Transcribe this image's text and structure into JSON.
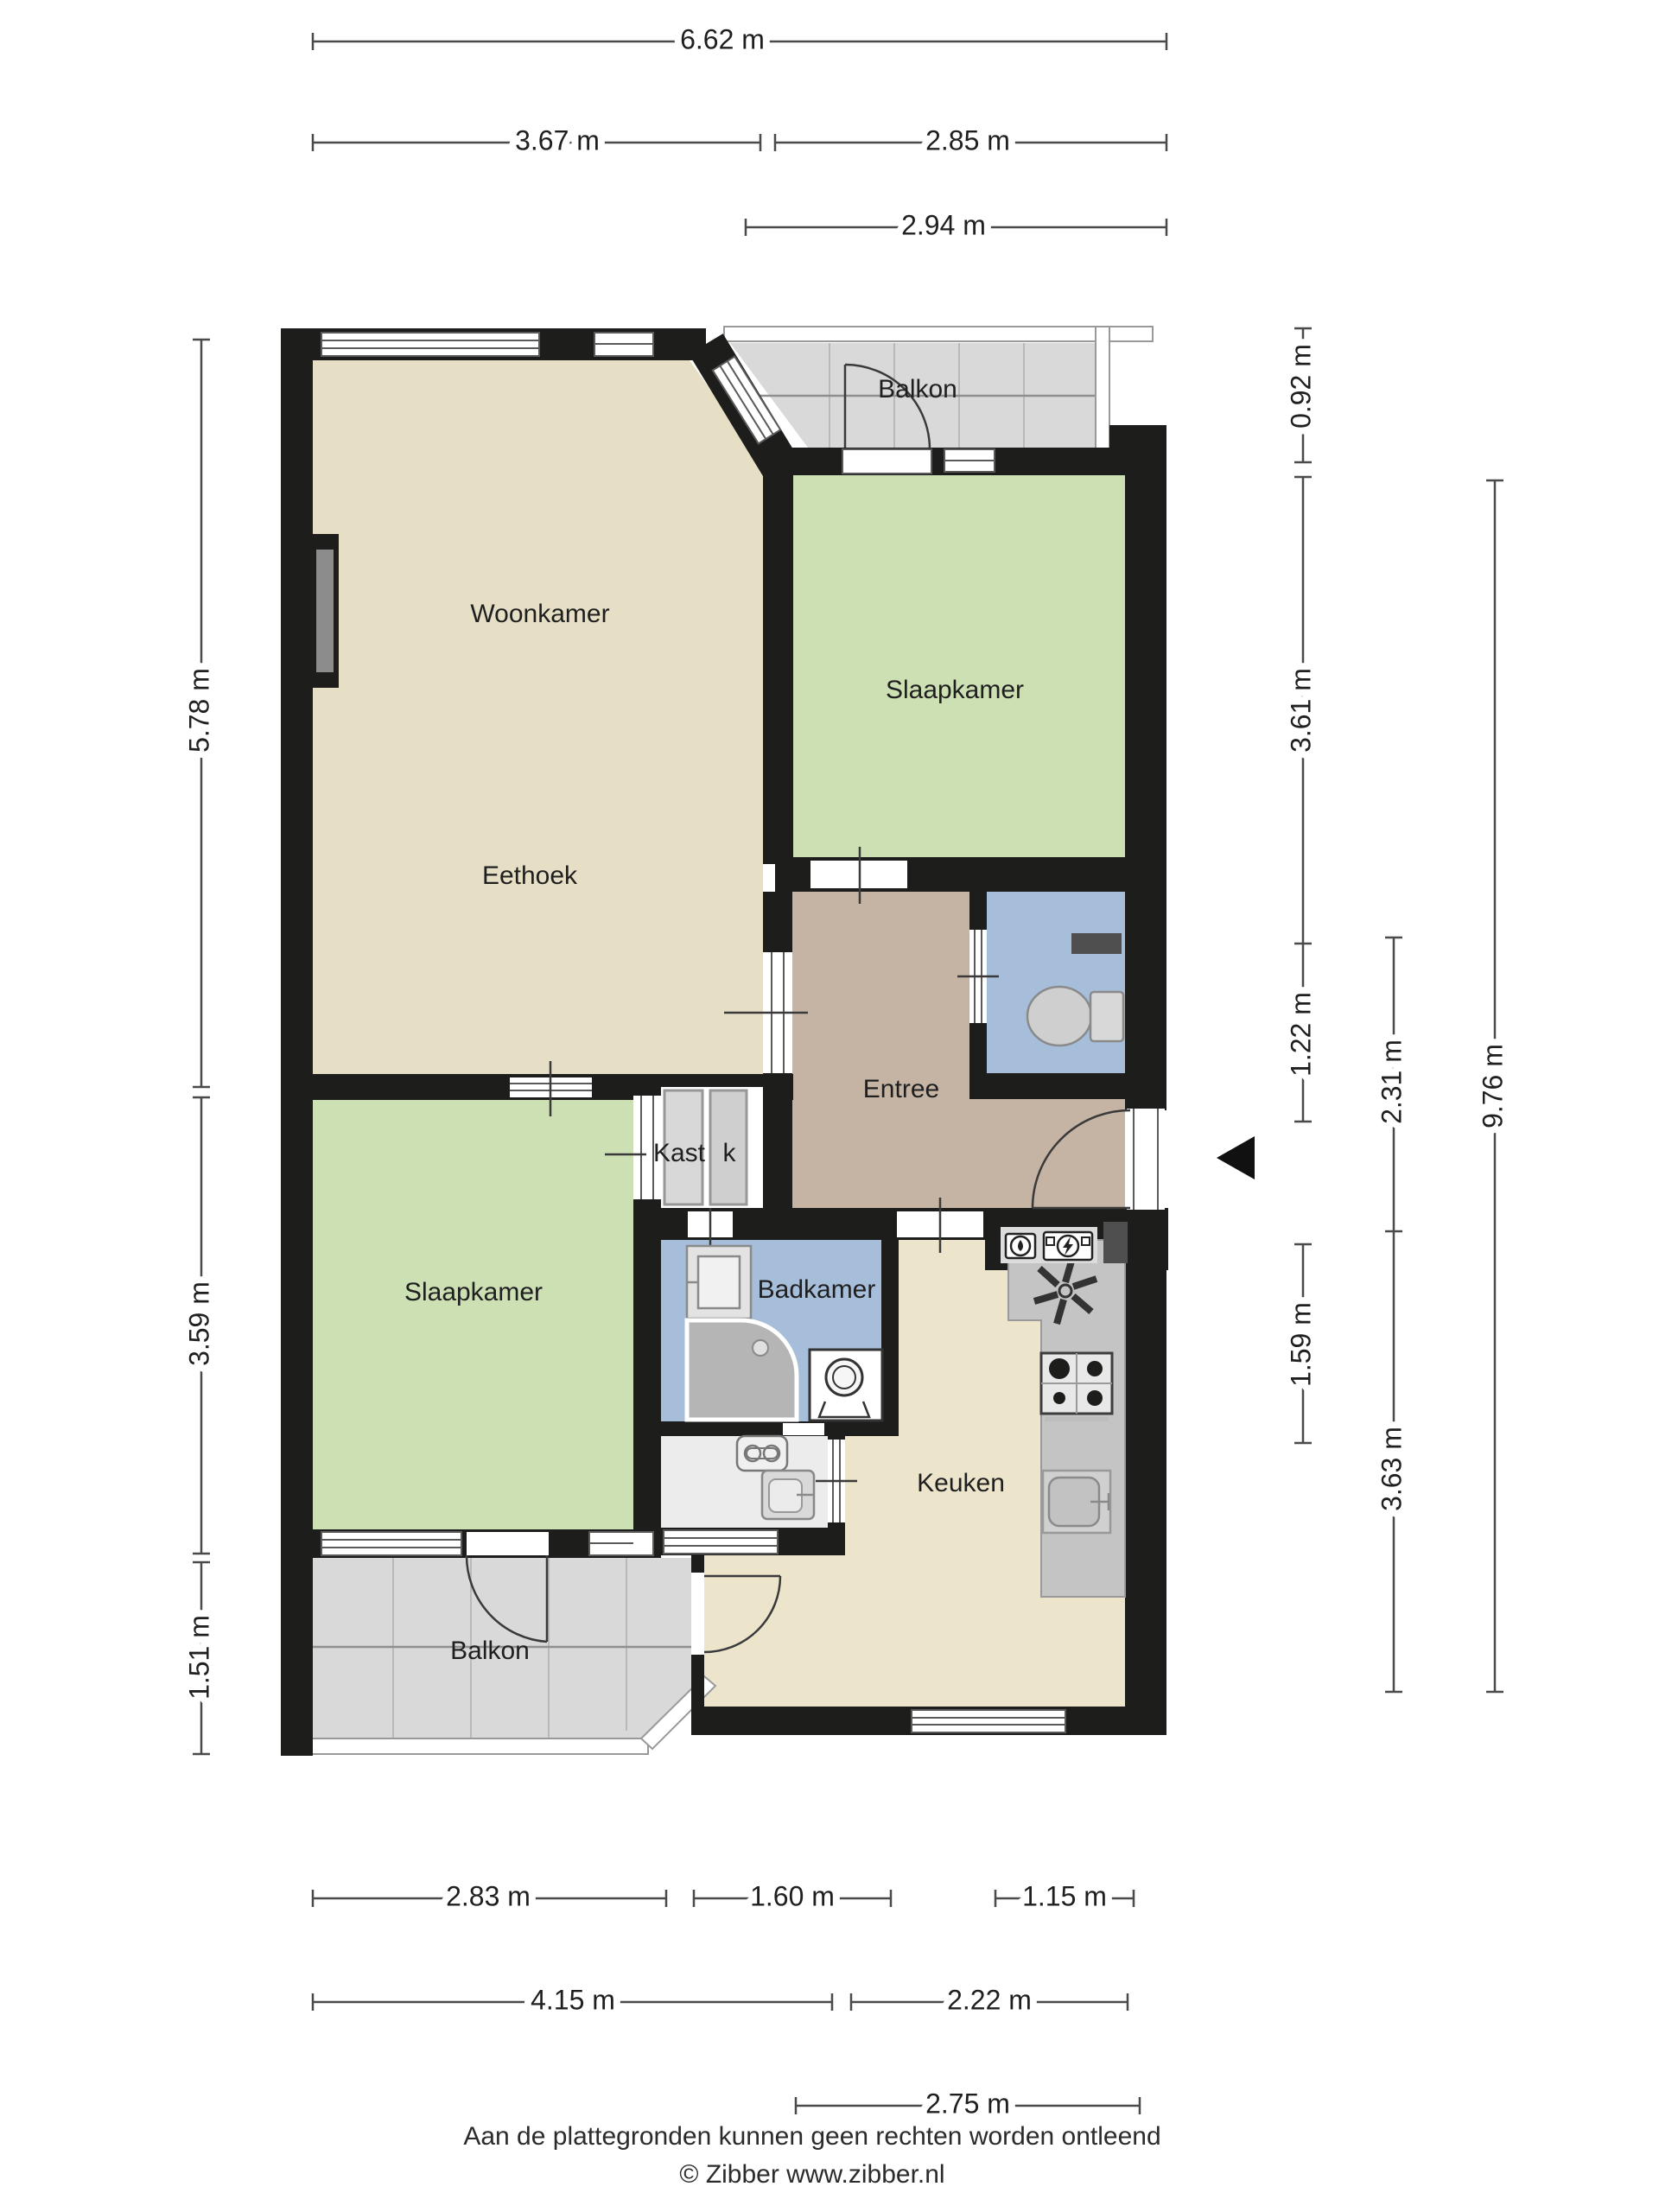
{
  "rooms": {
    "balkon_top": {
      "label": "Balkon"
    },
    "woonkamer": {
      "label": "Woonkamer"
    },
    "slaapkamer_top": {
      "label": "Slaapkamer"
    },
    "eethoek": {
      "label": "Eethoek"
    },
    "entree": {
      "label": "Entree"
    },
    "kast": {
      "label": "Kast"
    },
    "kast_small": {
      "label": "k"
    },
    "slaapkamer_onder": {
      "label": "Slaapkamer"
    },
    "badkamer": {
      "label": "Badkamer"
    },
    "keuken": {
      "label": "Keuken"
    },
    "balkon_onder": {
      "label": "Balkon"
    }
  },
  "dimensions": {
    "top": [
      {
        "label": "6.62 m"
      },
      {
        "label": "3.67 m"
      },
      {
        "label": "2.85 m"
      },
      {
        "label": "2.94 m"
      }
    ],
    "left": [
      {
        "label": "5.78 m"
      },
      {
        "label": "3.59 m"
      },
      {
        "label": "1.51 m"
      }
    ],
    "right": [
      {
        "label": "0.92 m"
      },
      {
        "label": "3.61 m"
      },
      {
        "label": "1.22 m"
      },
      {
        "label": "1.59 m"
      },
      {
        "label": "2.31 m"
      },
      {
        "label": "3.63 m"
      },
      {
        "label": "9.76 m"
      }
    ],
    "bottom": [
      {
        "label": "2.83 m"
      },
      {
        "label": "1.60 m"
      },
      {
        "label": "1.15 m"
      },
      {
        "label": "4.15 m"
      },
      {
        "label": "2.22 m"
      },
      {
        "label": "2.75 m"
      }
    ]
  },
  "footer": {
    "disclaimer": "Aan de plattegronden kunnen geen rechten worden ontleend",
    "copyright": "© Zibber www.zibber.nl"
  },
  "colors": {
    "wall": "#1d1d1b",
    "living": "#e6dfc6",
    "bedroom": "#cde0b4",
    "hall": "#c5b4a3",
    "bath": "#a7bedb",
    "kitchen": "#ece4cb",
    "balcony": "#d9d9d9",
    "counter": "#c4c4c4",
    "closet": "#d8d8d8"
  },
  "fixtures": {
    "toilet": "toilet",
    "shower": "corner-shower",
    "washer": "washing-machine",
    "sink": "wash-basin",
    "stove": "cooktop-4-burners",
    "kitchen_sink": "kitchen-sink",
    "extractor": "extractor-fan",
    "water_meter": "water-meter",
    "electric_meter": "electricity-meter",
    "chimney": "chimney-duct",
    "entry_arrow": "entrance-arrow"
  }
}
